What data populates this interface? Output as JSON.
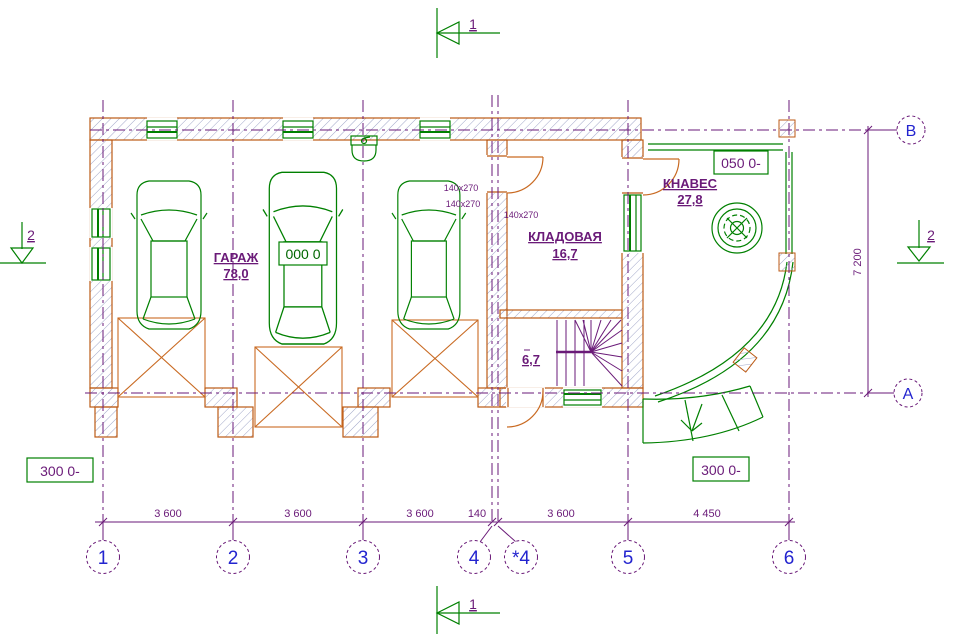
{
  "colors": {
    "wall_outline": "#bc5a14",
    "hatch": "#a0a6c8",
    "green": "#008000",
    "purple": "#6a1a78",
    "blue": "#2324cf",
    "plate_text": "#006600",
    "ramp_orange": "#c96a22",
    "background": "#ffffff"
  },
  "section_marks": {
    "top": "1",
    "bottom": "1",
    "left": "2",
    "right": "2"
  },
  "grid": {
    "columns": [
      "1",
      "2",
      "3",
      "4",
      "*4",
      "5",
      "6"
    ],
    "row_top": "В",
    "row_bottom": "А"
  },
  "dimensions": {
    "bay1": "3 600",
    "bay2": "3 600",
    "bay3": "3 600",
    "gap": "140",
    "bay4": "3 600",
    "bay5": "4 450",
    "height": "7 200"
  },
  "rooms": {
    "garage_name": "ГАРАЖ",
    "garage_area": "78,0",
    "storage_name": "КЛАДОВАЯ",
    "storage_area": "16,7",
    "canopy_name": "КНАВЕС",
    "canopy_area": "27,8",
    "stair_area": "6,7"
  },
  "tags": {
    "plate": "000 0",
    "level_canopy": "050 0-",
    "level_left": "300 0-",
    "level_right": "300 0-",
    "door_tags": [
      "140x270",
      "140x270",
      "140x270"
    ]
  }
}
